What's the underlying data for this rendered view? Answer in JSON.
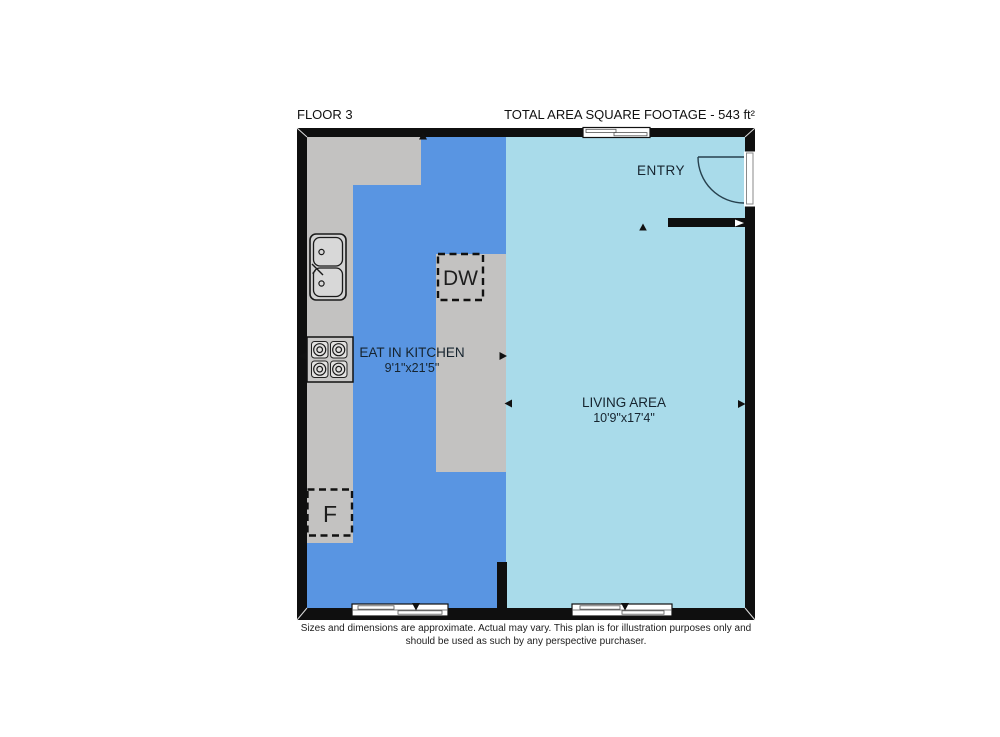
{
  "header": {
    "floor_label": "FLOOR 3",
    "total_area_label": "TOTAL AREA SQUARE FOOTAGE - 543 ft²"
  },
  "rooms": {
    "kitchen": {
      "name": "EAT IN KITCHEN",
      "dimensions": "9'1\"x21'5\""
    },
    "living": {
      "name": "LIVING AREA",
      "dimensions": "10'9\"x17'4\""
    },
    "entry": {
      "name": "ENTRY"
    }
  },
  "appliances": {
    "dishwasher_label": "DW",
    "fridge_label": "F"
  },
  "footer": {
    "disclaimer_line1": "Sizes and dimensions are approximate. Actual may vary. This plan is for illustration purposes only and",
    "disclaimer_line2": "should be used as such by any perspective purchaser."
  },
  "colors": {
    "kitchen_floor": "#5995e2",
    "living_floor": "#a9dbea",
    "counter": "#c3c2c1",
    "wall": "#0f0f0f"
  }
}
